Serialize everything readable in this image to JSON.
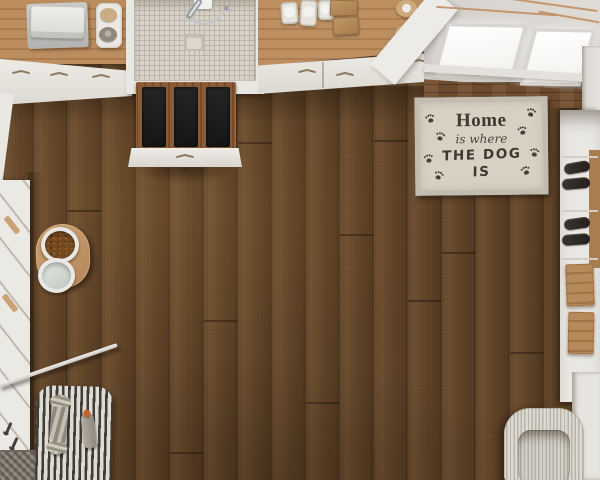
{
  "scene": {
    "type": "top-down 3D interior render",
    "room": "pet room with dog wash station, wood floor, shelving and pet beds"
  },
  "mat_sign": {
    "line1": "Home",
    "line2": "is where",
    "line3": "THE DOG IS",
    "paw_print_count": 8
  },
  "colors": {
    "floor_wood": "#5d4228",
    "counter_wood": "#b5875a",
    "wall_wood_paneling": "#6b4a2e",
    "cabinet_white": "#e9e7e2",
    "shower_tile": "#d8d3ca",
    "mat_background": "#d7d0c3",
    "mat_border": "#c3bbad",
    "mat_text": "#3e3831",
    "bench_cushion_black": "#1c1d1d",
    "kibble_brown": "#74491f",
    "striped_mat_dark": "#403d39",
    "striped_mat_light": "#dedbd3",
    "pet_bed_cream": "#d8d5cc",
    "window_light": "#fbfaf7",
    "copper_pipe": "#c08a5c"
  },
  "objects": [
    "wood plank floor",
    "counter with folded towels",
    "tray with soaps",
    "tiled dog shower with hand shower and drain",
    "counter with canisters, kraft boxes and rolls",
    "white drawer cabinets",
    "skylight windows",
    "wood wall paneling",
    "dog welcome mat with paw prints",
    "shoe shelf with shoes and wood drawers",
    "wall bench with black cushions",
    "dog food and water bowls on wood tray",
    "leash hooks and woven basket",
    "white rod",
    "striped pet mat with rope toy and chew toy",
    "ribbed cream pet bed"
  ]
}
